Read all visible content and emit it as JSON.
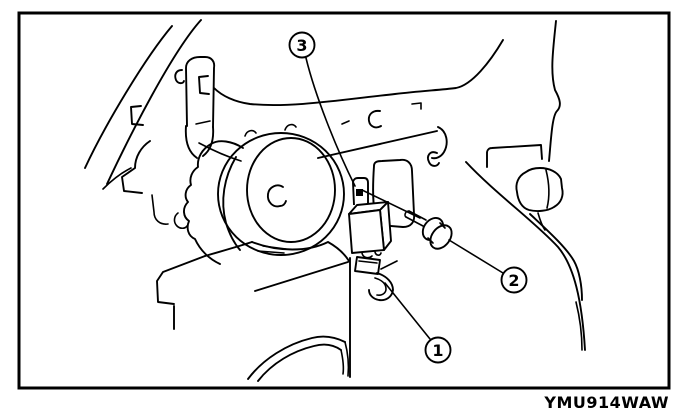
{
  "figure": {
    "code": "YMU914WAW",
    "background_color": "#ffffff",
    "line_color": "#000000"
  },
  "callouts": [
    {
      "label": "1",
      "target": "hook-clip"
    },
    {
      "label": "2",
      "target": "mounting-bolt"
    },
    {
      "label": "3",
      "target": "control-unit-bracket"
    }
  ]
}
